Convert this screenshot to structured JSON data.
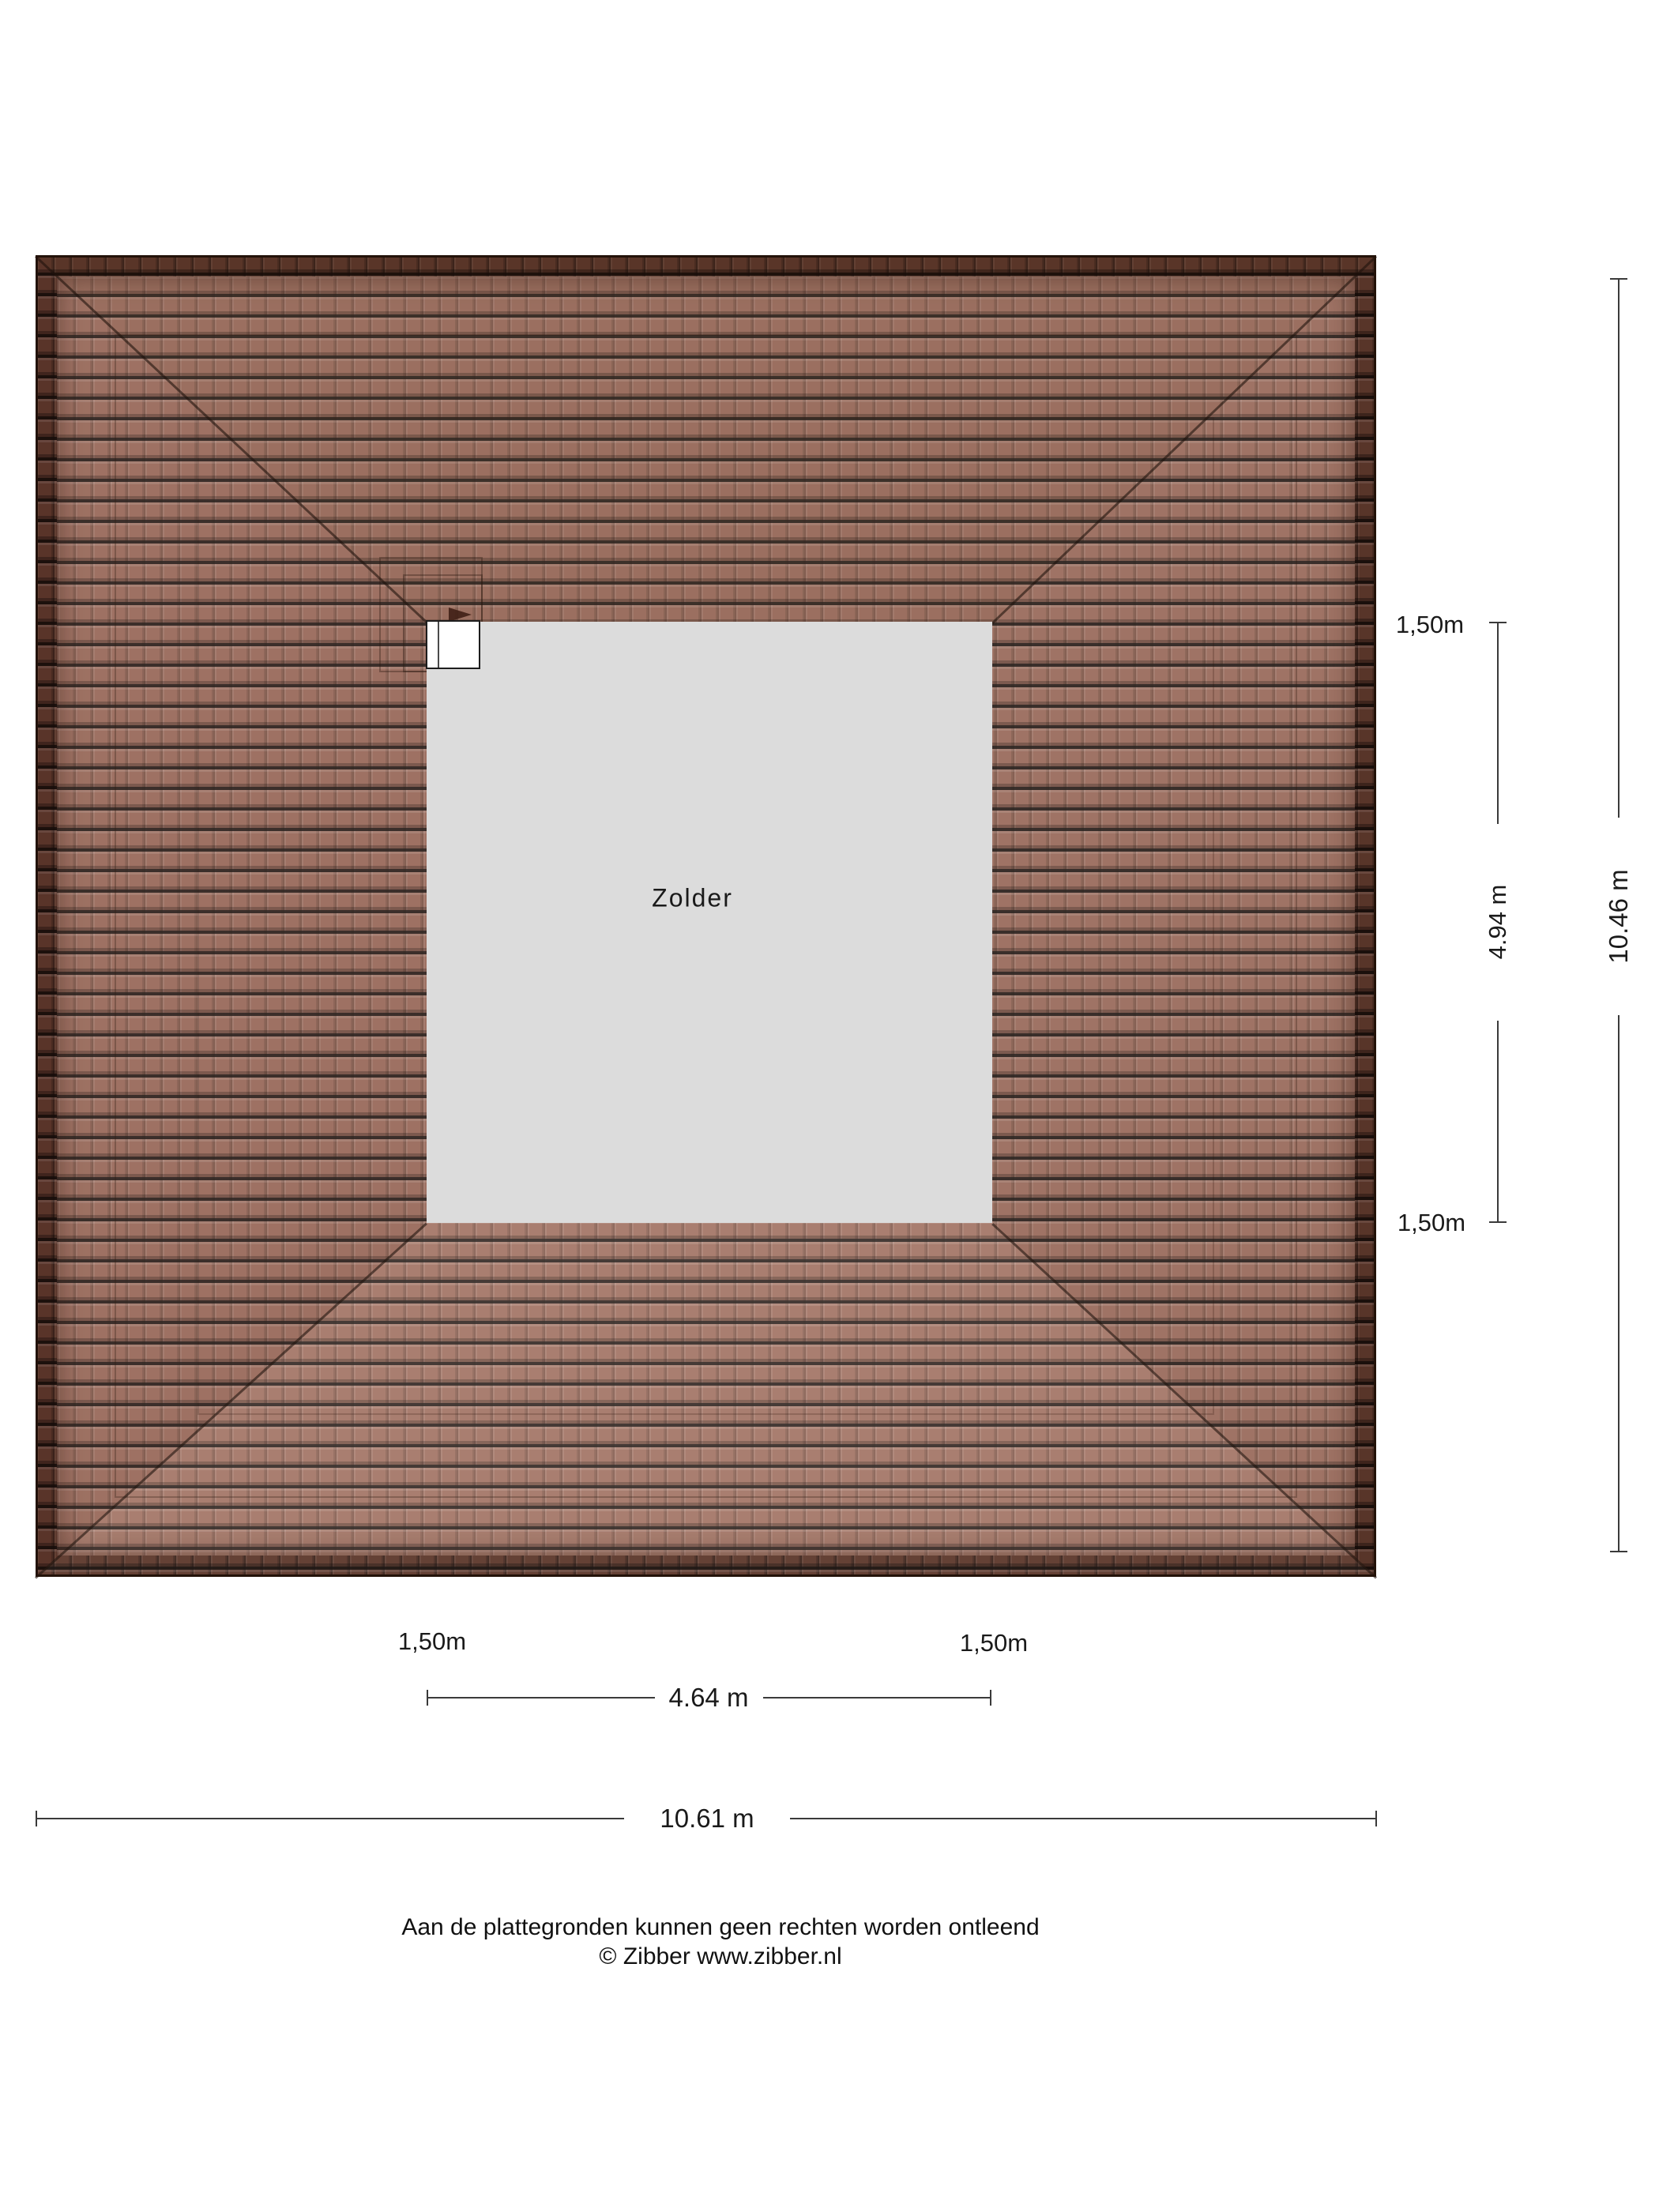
{
  "plan": {
    "room_label": "Zolder"
  },
  "dimensions": {
    "right": {
      "top_offset": "1,50m",
      "inner": "4.94 m",
      "total": "10.46 m",
      "bottom_offset": "1,50m"
    },
    "bottom": {
      "left_offset": "1,50m",
      "right_offset": "1,50m",
      "inner": "4.64 m",
      "total": "10.61 m"
    }
  },
  "footer": {
    "disclaimer": "Aan de plattegronden kunnen geen rechten worden ontleend",
    "copyright": "© Zibber www.zibber.nl"
  },
  "colors": {
    "roof_tile": "#a57869",
    "roof_ridge_band": "#5c372b",
    "roof_outline": "#231209",
    "attic_fill": "#dcdcdc",
    "dimension_line": "#3a3a3a",
    "text": "#1a1a1a"
  }
}
